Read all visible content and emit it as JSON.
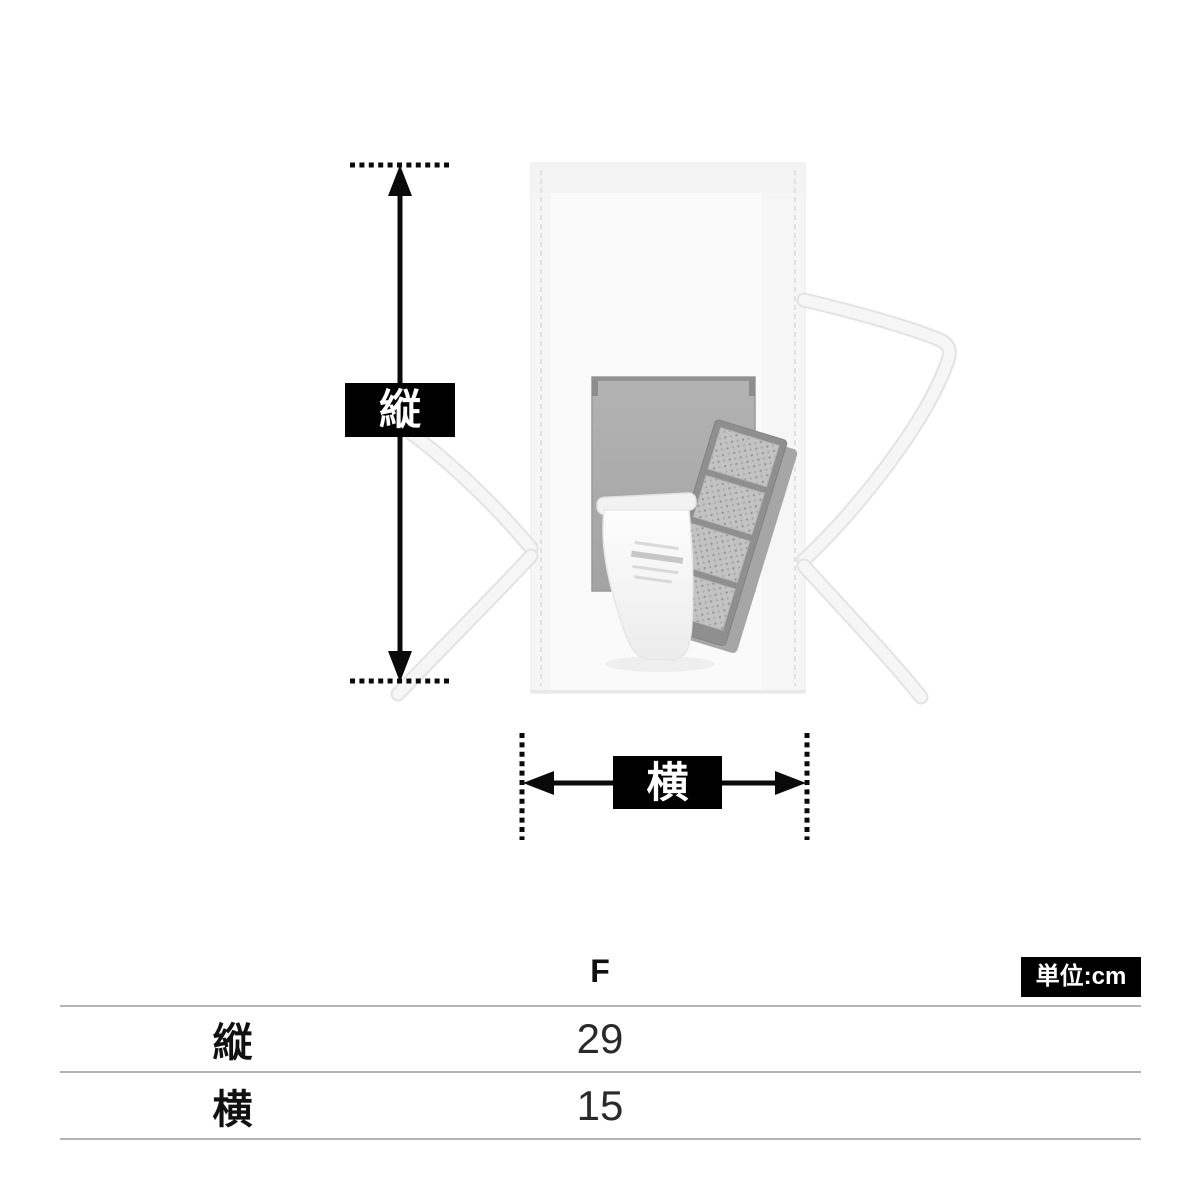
{
  "diagram": {
    "vertical_dim_label": "縦",
    "horizontal_dim_label": "横",
    "illustration_parts": [
      "drawstring-bag",
      "left-drawstring-ribbon",
      "right-drawstring-ribbon",
      "compact-mirror",
      "eyeshadow-palette",
      "cosmetic-tube"
    ]
  },
  "size_table": {
    "size_column_header": "F",
    "unit_badge": "単位:cm",
    "rows": [
      {
        "label": "縦",
        "value": "29"
      },
      {
        "label": "横",
        "value": "15"
      }
    ]
  },
  "colors": {
    "annotation": "#0a0a0a",
    "label_box_bg": "#000000",
    "label_box_text": "#ffffff",
    "badge_bg": "#000000",
    "badge_text": "#ffffff",
    "table_line": "#b4b4b4",
    "text": "#1a1a1a",
    "background": "#ffffff"
  }
}
